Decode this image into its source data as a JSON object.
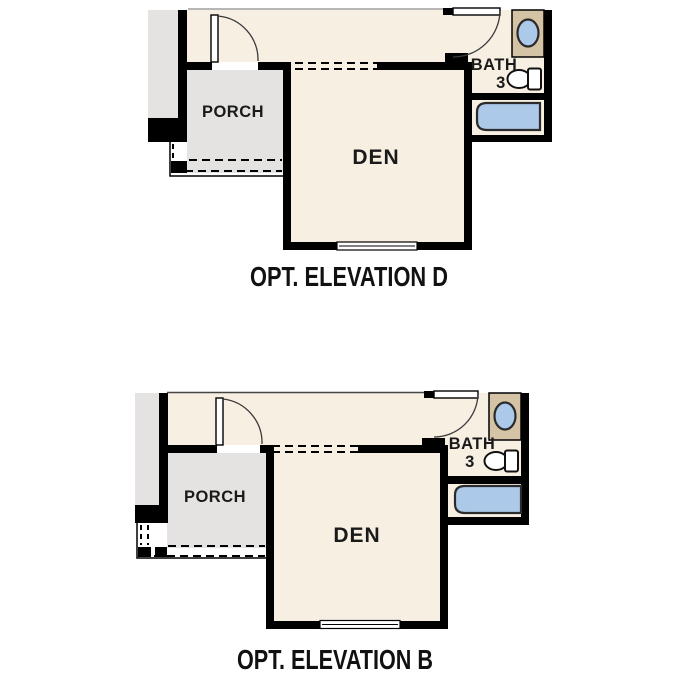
{
  "sheet_title": "Optional elevation floor plan details",
  "plans": [
    {
      "id": "elevation-d",
      "caption": "OPT. ELEVATION D",
      "rooms": {
        "porch": "PORCH",
        "den": "DEN",
        "bath": "BATH",
        "bath_number": "3"
      }
    },
    {
      "id": "elevation-b",
      "caption": "OPT. ELEVATION B",
      "rooms": {
        "porch": "PORCH",
        "den": "DEN",
        "bath": "BATH",
        "bath_number": "3"
      }
    }
  ],
  "colors": {
    "interior": "#f8efe3",
    "porch": "#e4e3e1",
    "counter": "#d5c3a5",
    "blue": "#adc9e9",
    "wall": "#000000",
    "text": "#1a1a1a"
  }
}
